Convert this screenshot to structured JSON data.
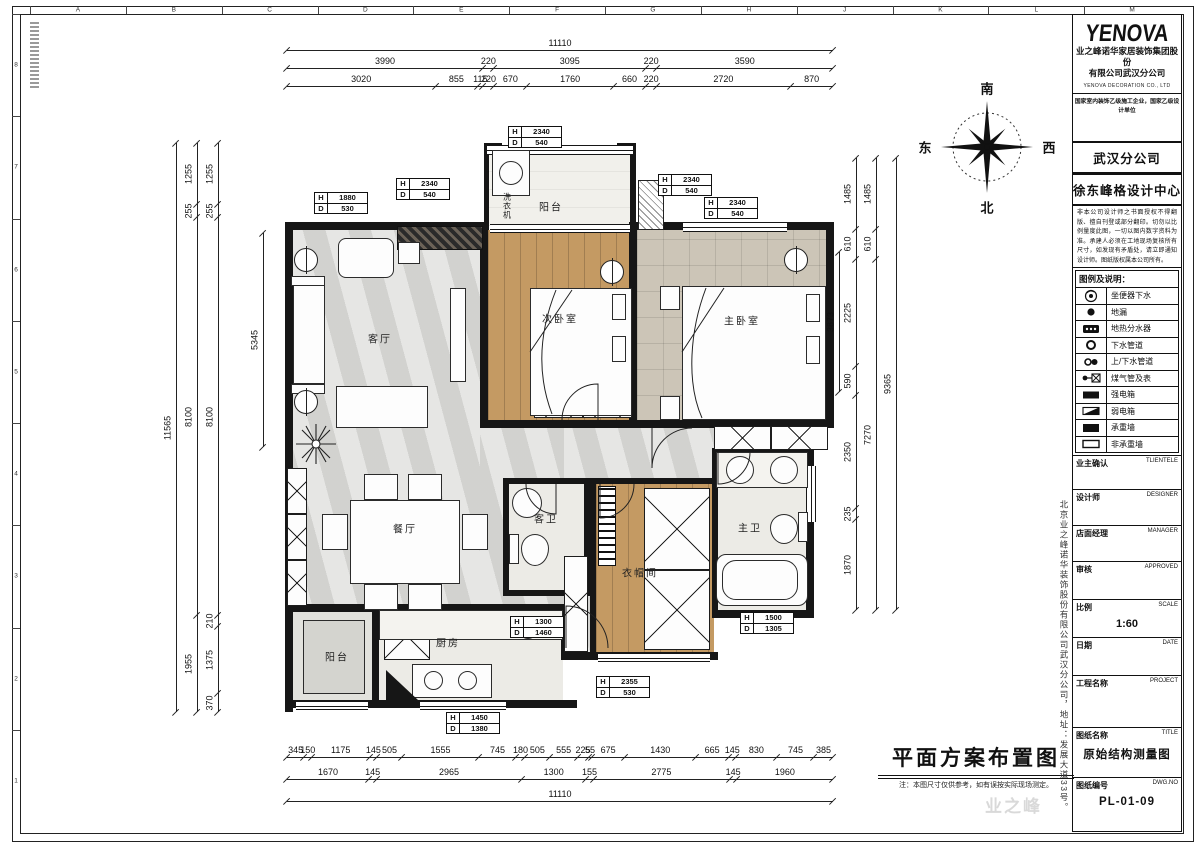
{
  "compass": {
    "south": "南",
    "north": "北",
    "east": "东",
    "west": "西"
  },
  "company": {
    "logo": "YENOVA",
    "name": "业之峰诺华家居装饰集团股份",
    "name2": "有限公司武汉分公司",
    "eng": "YENOVA DECORATION CO., LTD",
    "cert": "国家室内装饰乙级施工企业，国家乙级设计单位",
    "branch": "武汉分公司",
    "center": "徐东峰格设计中心",
    "disclaimer": "非本公司设计师之书面授权不得翻版、擅自刊登或部分翻印。切勿以比例量度此图，一切以图内数字资料为准。承建人必须在工地现场复核所有尺寸，如发现有矛盾处，请立即通知设计师。图纸版权属本公司所有。"
  },
  "legend": {
    "title": "图例及说明：",
    "rows": [
      {
        "icon": "toilet-drain",
        "label": "坐便器下水"
      },
      {
        "icon": "floor-drain",
        "label": "地漏"
      },
      {
        "icon": "heating-manifold",
        "label": "地热分水器"
      },
      {
        "icon": "drain-pipe",
        "label": "下水管道"
      },
      {
        "icon": "water-pipes",
        "label": "上/下水管道"
      },
      {
        "icon": "gas-meter",
        "label": "煤气管及表"
      },
      {
        "icon": "strong-power-box",
        "label": "强电箱"
      },
      {
        "icon": "weak-power-box",
        "label": "弱电箱"
      },
      {
        "icon": "bearing-wall",
        "label": "承重墙"
      },
      {
        "icon": "non-bearing-wall",
        "label": "非承重墙"
      }
    ]
  },
  "fields": [
    {
      "cn": "业主确认",
      "en": "TLIENTELE",
      "value": ""
    },
    {
      "cn": "设计师",
      "en": "DESIGNER",
      "value": ""
    },
    {
      "cn": "店面经理",
      "en": "MANAGER",
      "value": ""
    },
    {
      "cn": "审核",
      "en": "APPROVED",
      "value": ""
    },
    {
      "cn": "比例",
      "en": "SCALE",
      "value": "1:60"
    },
    {
      "cn": "日期",
      "en": "DATE",
      "value": ""
    },
    {
      "cn": "工程名称",
      "en": "PROJECT",
      "value": ""
    },
    {
      "cn": "图纸名称",
      "en": "TITLE",
      "value": "原始结构测量图"
    },
    {
      "cn": "图纸编号",
      "en": "DWG.NO",
      "value": "PL-01-09"
    }
  ],
  "drawing_title": {
    "text": "平面方案布置图",
    "note": "注：本图尺寸仅供参考，如有误按实际现场测定。"
  },
  "side_text": "北京业之峰诺华装饰股份有限公司武汉分公司，地址：发展大道33号。",
  "watermark": "业之峰",
  "rooms": {
    "living": "客厅",
    "dining": "餐厅",
    "bed2": "次卧室",
    "master": "主卧室",
    "balcony_top": "阳台",
    "balcony_bottom": "阳台",
    "kitchen": "厨房",
    "bath_guest": "客卫",
    "bath_master": "主卫",
    "cloak": "衣帽间",
    "washer": "洗衣机"
  },
  "grid": {
    "top_letters": [
      "A",
      "B",
      "C",
      "D",
      "E",
      "F",
      "G",
      "H",
      "J",
      "K",
      "L",
      "M"
    ],
    "left_numbers": [
      "8",
      "7",
      "6",
      "5",
      "4",
      "3",
      "2",
      "1"
    ]
  },
  "window_tags": [
    {
      "h": "1880",
      "d": "530",
      "x": 314,
      "y": 192
    },
    {
      "h": "2340",
      "d": "540",
      "x": 396,
      "y": 178
    },
    {
      "h": "2340",
      "d": "540",
      "x": 508,
      "y": 126
    },
    {
      "h": "2340",
      "d": "540",
      "x": 658,
      "y": 174
    },
    {
      "h": "2340",
      "d": "540",
      "x": 704,
      "y": 197
    },
    {
      "h": "1300",
      "d": "1460",
      "x": 510,
      "y": 616
    },
    {
      "h": "1500",
      "d": "1305",
      "x": 740,
      "y": 612
    },
    {
      "h": "2355",
      "d": "530",
      "x": 596,
      "y": 676
    },
    {
      "h": "1450",
      "d": "1380",
      "x": 446,
      "y": 712
    }
  ],
  "dims": {
    "top": [
      {
        "y": 50,
        "x1": 287,
        "x2": 833,
        "segments": [
          11110
        ]
      },
      {
        "y": 68,
        "x1": 287,
        "x2": 833,
        "segments": [
          3990,
          220,
          3095,
          220,
          3590
        ]
      },
      {
        "y": 86,
        "x1": 287,
        "x2": 833,
        "segments": [
          3020,
          855,
          115,
          220,
          670,
          1760,
          660,
          220,
          2720,
          870
        ]
      }
    ],
    "bottom": [
      {
        "y": 757,
        "x1": 287,
        "x2": 833,
        "segments": [
          345,
          150,
          1175,
          145,
          505,
          1555,
          745,
          180,
          505,
          555,
          225,
          55,
          675,
          1430,
          665,
          145,
          830,
          745,
          385
        ]
      },
      {
        "y": 779,
        "x1": 287,
        "x2": 833,
        "segments": [
          1670,
          145,
          2965,
          1300,
          155,
          2775,
          145,
          1960
        ]
      },
      {
        "y": 801,
        "x1": 287,
        "x2": 833,
        "segments": [
          11110
        ]
      }
    ],
    "left": [
      {
        "x": 176,
        "y1": 143,
        "y2": 712,
        "segments": [
          11565
        ]
      },
      {
        "x": 197,
        "y1": 143,
        "y2": 712,
        "segments": [
          1255,
          255,
          8100,
          1955
        ]
      },
      {
        "x": 218,
        "y1": 143,
        "y2": 712,
        "segments": [
          1255,
          255,
          8100,
          210,
          1375,
          370
        ]
      }
    ],
    "right": [
      {
        "x": 856,
        "y1": 158,
        "y2": 610,
        "segments": [
          1485,
          610,
          2225,
          590,
          2350,
          235,
          1870
        ]
      },
      {
        "x": 876,
        "y1": 158,
        "y2": 610,
        "segments": [
          1485,
          610,
          7270
        ]
      },
      {
        "x": 896,
        "y1": 158,
        "y2": 610,
        "segments": [
          9365
        ]
      }
    ],
    "interior": [
      {
        "x": 263,
        "y1": 233,
        "y2": 447,
        "segments": [
          5345
        ]
      },
      {
        "x": 839,
        "y1": 252,
        "y2": 392,
        "segments": [
          3873
        ]
      }
    ]
  }
}
